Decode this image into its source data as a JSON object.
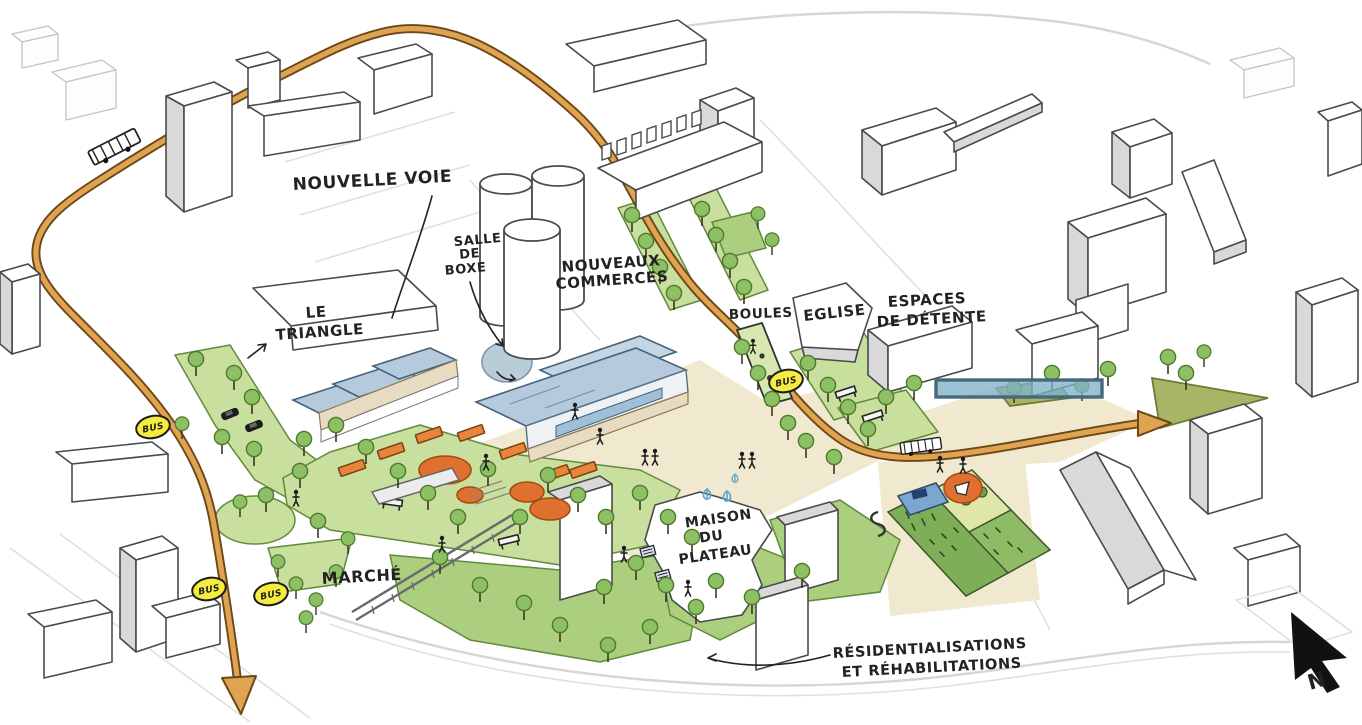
{
  "labels": {
    "nouvelle_voie": "NOUVELLE VOIE",
    "salle_de_boxe": [
      "SALLE",
      "DE",
      "BOXE"
    ],
    "nouveaux_commerces": [
      "NOUVEAUX",
      "COMMERCES"
    ],
    "le_triangle": [
      "LE",
      "TRIANGLE"
    ],
    "boules": "BOULES",
    "eglise": "EGLISE",
    "espaces_de_detente": [
      "ESPACES",
      "DE DÉTENTE"
    ],
    "maison_du_plateau": [
      "MAISON",
      "DU",
      "PLATEAU"
    ],
    "marche": "MARCHÉ",
    "residentialisations": [
      "RÉSIDENTIALISATIONS",
      "ET RÉHABILITATIONS"
    ],
    "bus": "BUS",
    "north": "N"
  },
  "colors": {
    "road": "#dfa452",
    "road-edge": "#6d4716",
    "lawn": "#c9df9e",
    "lawn-dark": "#abcf7f",
    "olive": "#a9b566",
    "tree": "#8cc063",
    "tree-edge": "#4e7a2e",
    "plaza": "#f0e9d0",
    "roof-blue": "#b5cbdd",
    "window-blue": "#9fc0d8",
    "cream-band": "#e7dcc2",
    "bus-yellow": "#f6ec3f",
    "play-orange": "#e0702f",
    "bench-orange": "#e8853a",
    "water-blue": "#b9cdd8",
    "garden-blue": "#7ba7cf",
    "highlight-fill": "#7fb2c8",
    "highlight-edge": "#47697e",
    "ink": "#222222",
    "building-edge": "#4a4a4a",
    "building-face": "#ffffff",
    "building-shade": "#d9d9d9",
    "faint": "#c4c4c4"
  }
}
